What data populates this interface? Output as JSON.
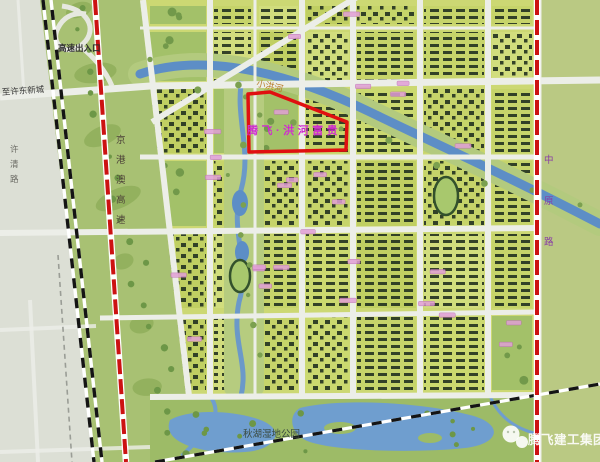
{
  "labels": {
    "highway_exit": "高速出入口",
    "to_xudong_newtown": "至许东新城",
    "xuqing_road": "许清路",
    "jinggangao_expressway": "京港澳高速",
    "xiaohong_river": "小洪河",
    "project_plot": "腾飞·洪河富贵",
    "zhongyuan_road": "中原路",
    "qiuhu_wetland_park": "秋湖湿地公园",
    "watermark_brand": "腾飞建工集团"
  },
  "colors": {
    "plot_outline": "#e01010",
    "expressway_line": "#cc1212",
    "project_label": "#cf2ecf",
    "river": "#5d8ec6",
    "zhongyuan_label": "#8a3fa5",
    "watermark_text": "#ffffff"
  }
}
